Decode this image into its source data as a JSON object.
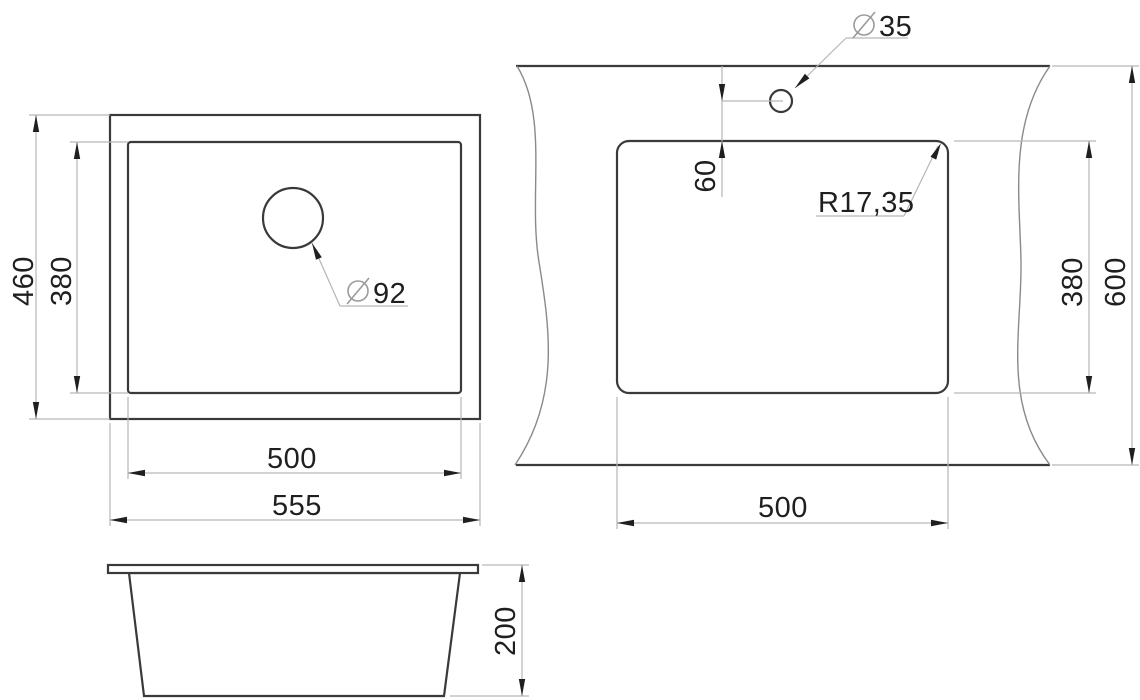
{
  "colors": {
    "background": "#ffffff",
    "line_dark": "#3a3a3a",
    "line_dim": "#b6b6b6",
    "line_wavy": "#8a8a8a",
    "ink": "#1f1f1f",
    "symbol": "#9b9b9b"
  },
  "views": {
    "plan": {
      "dimensions": {
        "outer_width": "555",
        "inner_width": "500",
        "outer_height": "460",
        "inner_height": "380"
      },
      "drain_hole": {
        "symbol": "⌀",
        "value": "92"
      }
    },
    "front": {
      "dimensions": {
        "height": "200"
      }
    },
    "cutout": {
      "dimensions": {
        "width": "500",
        "height": "380",
        "counter_height": "600",
        "hole_offset": "60",
        "corner_radius": "R17,35"
      },
      "faucet_hole": {
        "symbol": "⌀",
        "value": "35"
      }
    }
  }
}
